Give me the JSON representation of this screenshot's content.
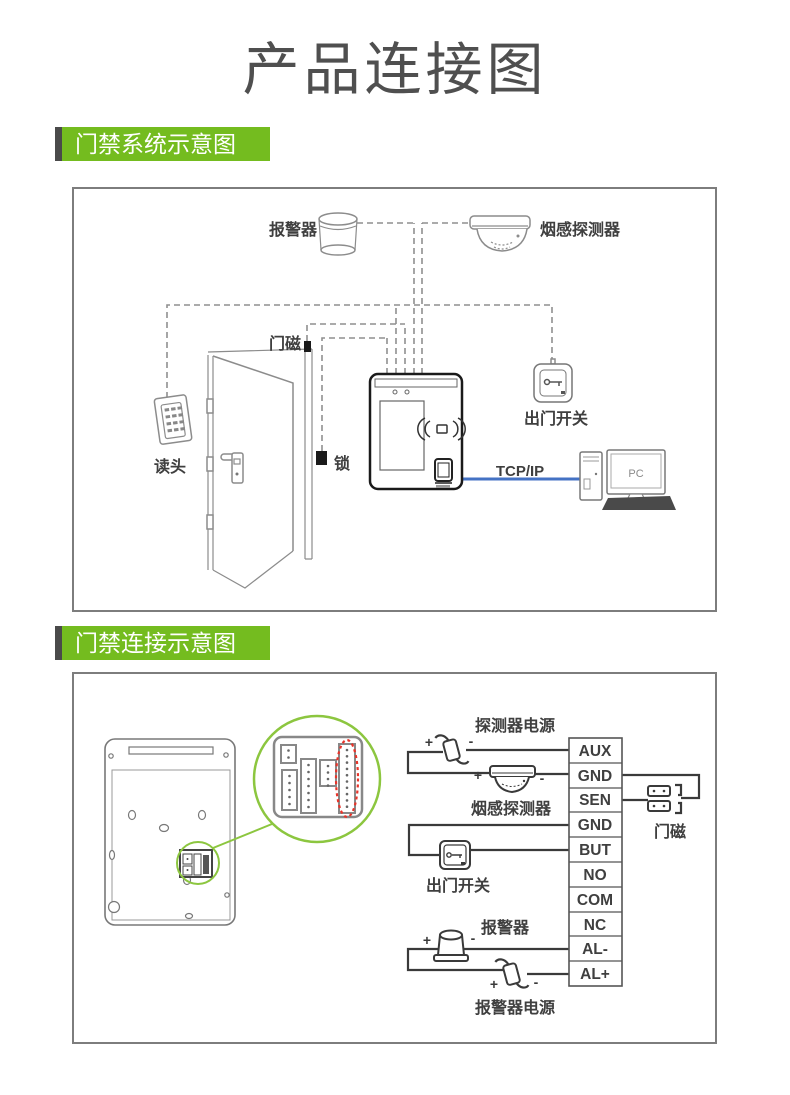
{
  "page": {
    "title": "产品连接图"
  },
  "colors": {
    "accent_green": "#74BC1F",
    "badge_bar": "#4A4A4A",
    "tcp_line_blue": "#4472C4",
    "callout_green": "#8CC63F",
    "highlight_red": "#E8342A"
  },
  "sections": {
    "system": {
      "badge": "门禁系统示意图"
    },
    "wiring": {
      "badge": "门禁连接示意图"
    }
  },
  "diagram1": {
    "labels": {
      "alarm": "报警器",
      "smoke_detector": "烟感探测器",
      "door_magnet": "门磁",
      "lock": "锁",
      "reader": "读头",
      "exit_button": "出门开关",
      "tcp": "TCP/IP",
      "pc": "PC"
    }
  },
  "diagram2": {
    "labels": {
      "detector_power": "探测器电源",
      "smoke_detector": "烟感探测器",
      "exit_button": "出门开关",
      "door_magnet": "门磁",
      "alarm": "报警器",
      "alarm_power": "报警器电源",
      "plus": "+",
      "minus": "-"
    },
    "terminal": {
      "pins": [
        "AUX",
        "GND",
        "SEN",
        "GND",
        "BUT",
        "NO",
        "COM",
        "NC",
        "AL-",
        "AL+"
      ]
    }
  }
}
